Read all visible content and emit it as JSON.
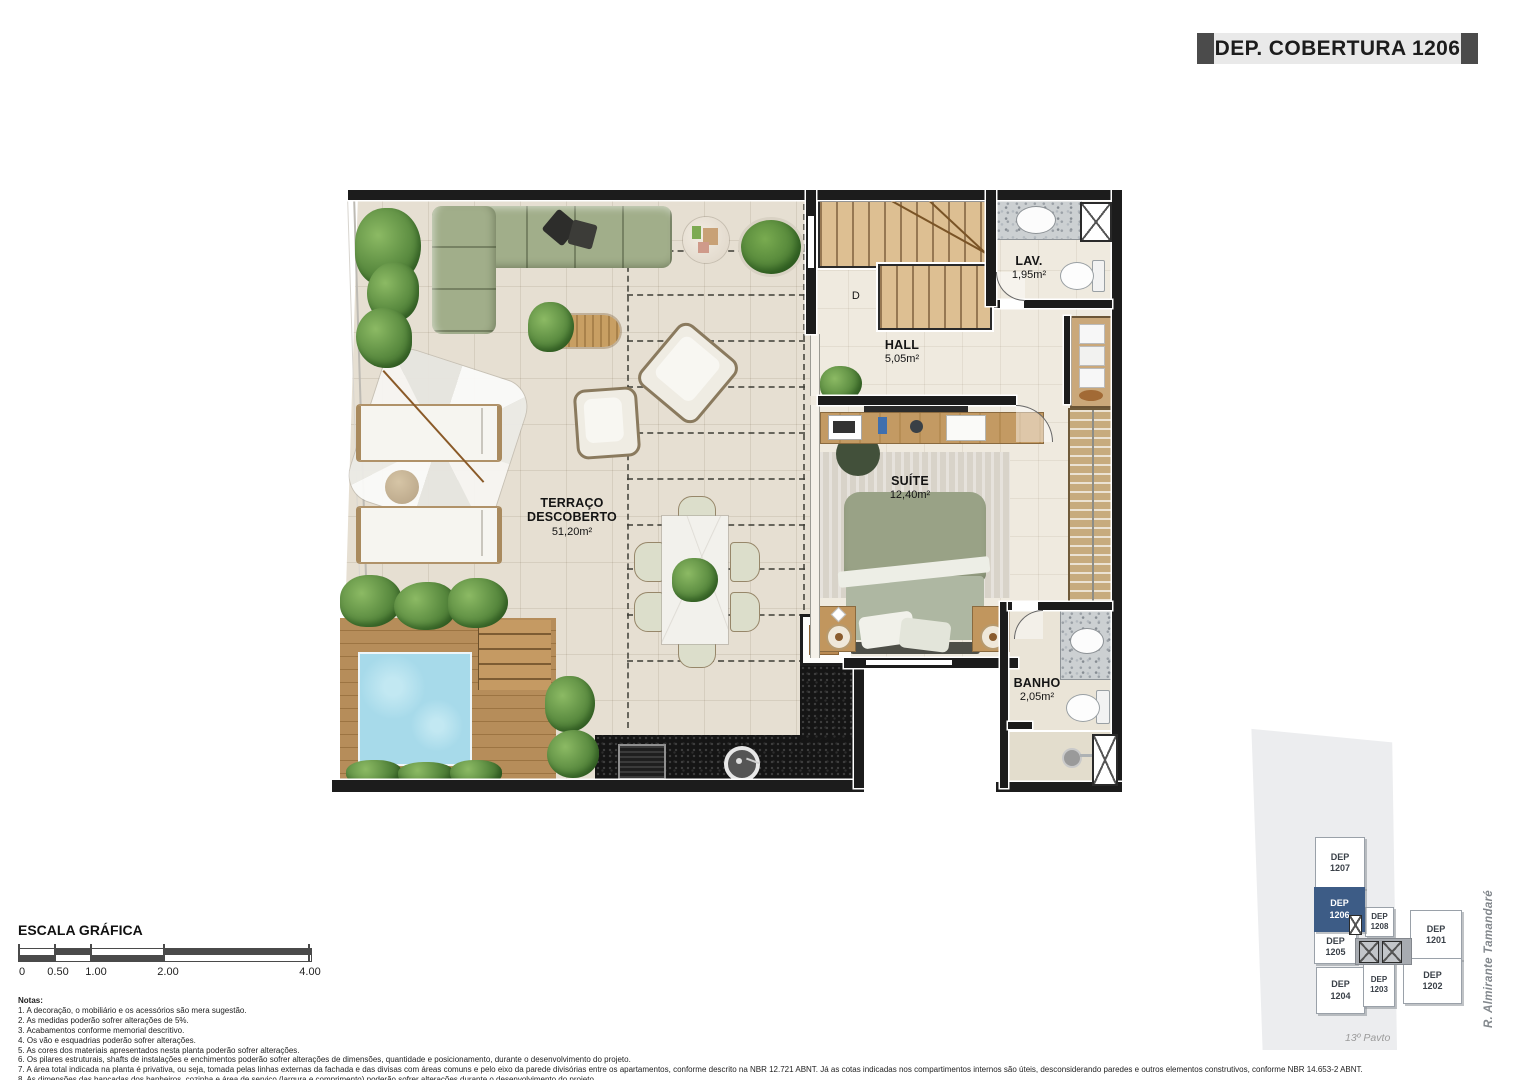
{
  "banner": {
    "title": "DEP. COBERTURA 1206"
  },
  "plan": {
    "rooms": {
      "terraco": {
        "name": "TERRAÇO\nDESCOBERTO",
        "area": "51,20m²"
      },
      "hall": {
        "name": "HALL",
        "area": "5,05m²"
      },
      "lav": {
        "name": "LAV.",
        "area": "1,95m²"
      },
      "suite": {
        "name": "SUÍTE",
        "area": "12,40m²"
      },
      "banho": {
        "name": "BANHO",
        "area": "2,05m²"
      }
    },
    "stair_door_label": "D"
  },
  "scalebar": {
    "title": "ESCALA GRÁFICA",
    "ticks": [
      "0",
      "0.50",
      "1.00",
      "2.00",
      "4.00"
    ]
  },
  "notes": {
    "heading": "Notas:",
    "items": [
      "1. A decoração, o mobiliário e os acessórios são mera sugestão.",
      "2. As medidas poderão sofrer alterações de 5%.",
      "3. Acabamentos conforme memorial descritivo.",
      "4. Os vão e esquadrias poderão sofrer alterações.",
      "5. As cores dos materiais apresentados nesta planta poderão sofrer alterações.",
      "6. Os pilares estruturais, shafts de instalações e enchimentos poderão sofrer alterações de dimensões, quantidade e posicionamento, durante o desenvolvimento do projeto.",
      "7. A área total indicada na planta é privativa, ou seja, tomada pelas linhas externas da fachada e das divisas com áreas comuns e pelo eixo da parede divisórias entre os apartamentos, conforme descrito na NBR 12.721 ABNT. Já as cotas indicadas nos compartimentos internos são úteis, desconsiderando paredes e outros elementos construtivos, conforme NBR 14.653-2 ABNT.",
      "8. As dimensões das bancadas dos banheiros, cozinha e área de serviço (largura e comprimento) poderão sofrer alterações durante o desenvolvimento do projeto.",
      "9. Os locais demarcados para o ar condicionado e respectivos equipamentos condensadores poderão sofrer alteração durante o desenvolvimento do projeto.",
      "10. No projeto foi considerado o uso de máquinas de ar condicionado do tipo multi-split. Em algumas unidades as condensadoras foram posicionadas de forma sobreposta (uma acima da outra)."
    ]
  },
  "keyplan": {
    "street": "R. Almirante Tamandaré",
    "floor_label": "13º Pavto",
    "highlighted_unit": "DEP 1206",
    "highlight_color": "#3d5c86",
    "units": {
      "u1207": "DEP\n1207",
      "u1206": "DEP\n1206",
      "u1208": "DEP\n1208",
      "u1205": "DEP\n1205",
      "u1201": "DEP\n1201",
      "u1204": "DEP\n1204",
      "u1203": "DEP\n1203",
      "u1202": "DEP\n1202"
    }
  }
}
